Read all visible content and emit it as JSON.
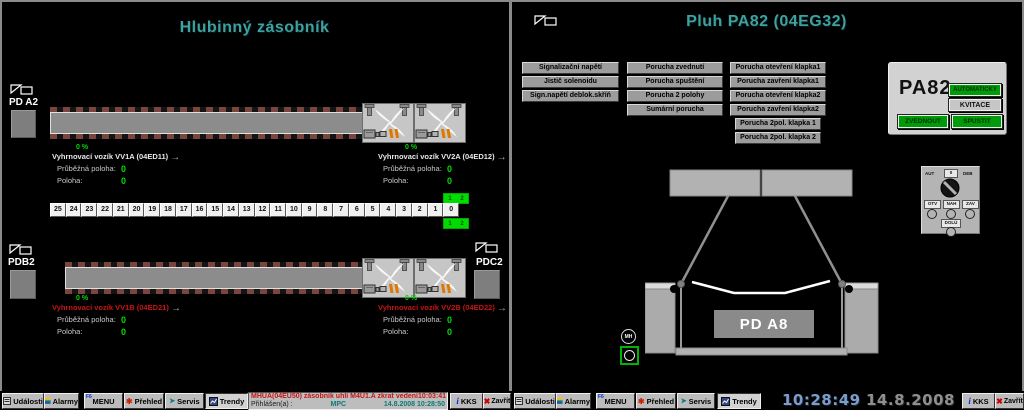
{
  "colors": {
    "teal": "#3FA0A0",
    "green": "#00DC00",
    "red": "#C81414",
    "btngreen": "#009A0A",
    "timeblue": "#7D9CC8",
    "dategray": "#8F8F8F",
    "statusgray": "#9C9C9C"
  },
  "left": {
    "title": "Hlubinný zásobník",
    "pd_a2": "PD A2",
    "pdb2": "PDB2",
    "pdc2": "PDC2",
    "pos_label": "Průběžná poloha:",
    "pos_label2": "Poloha:",
    "arrow": "→",
    "carts": {
      "vv1a": {
        "percent": "0 %",
        "label": "Vyhrnovací vozík VV1A (04ED11)",
        "style": "color:#e8e8e8",
        "v1": "0",
        "v2": "0"
      },
      "vv2a": {
        "percent": "0 %",
        "label": "Vyhrnovací vozík VV2A (04ED12)",
        "style": "color:#e8e8e8",
        "v1": "0",
        "v2": "0"
      },
      "vv1b": {
        "percent": "0 %",
        "label": "Vyhrnovací vozík VV1B (04ED21)",
        "style": "color:#C81414",
        "v1": "0",
        "v2": "0"
      },
      "vv2b": {
        "percent": "0 %",
        "label": "Vyhrnovací vozík VV2B (04ED22)",
        "style": "color:#C81414",
        "v1": "0",
        "v2": "0"
      }
    },
    "scale": {
      "cells": [
        "25",
        "24",
        "23",
        "22",
        "21",
        "20",
        "19",
        "18",
        "17",
        "16",
        "15",
        "14",
        "13",
        "12",
        "11",
        "10",
        "9",
        "8",
        "7",
        "6",
        "5",
        "4",
        "3",
        "2",
        "1",
        "0"
      ],
      "marker_a": "1",
      "marker_b": "2"
    }
  },
  "right": {
    "title": "Pluh PA82 (04EG32)",
    "status_col1": [
      "Signalizační napětí",
      "Jistič solenoidu",
      "Sign.napětí deblok.skříň"
    ],
    "status_col2": [
      "Porucha zvednutí",
      "Porucha spuštění",
      "Porucha 2 polohy",
      "Sumární porucha"
    ],
    "status_col3": [
      "Porucha otevření klapka1",
      "Porucha zavření klapka1",
      "Porucha otevření klapka2",
      "Porucha zavření klapka2",
      "Porucha 2pol. klapka 1",
      "Porucha 2pol. klapka 2"
    ],
    "control": {
      "name": "PA82",
      "auto": "AUTOMATICKY",
      "ack": "KVITACE",
      "raise": "ZVEDNOUT",
      "start": "SPUSTIT"
    },
    "pd_a8": "PD A8",
    "mh": "MH",
    "switch": {
      "left": "AUT",
      "mid": "0",
      "right": "DEB",
      "open": "OTV",
      "up": "NAH",
      "close": "ZAV",
      "down": "DOLŮ"
    }
  },
  "taskbar": {
    "buttons": [
      "Události",
      "Alarmy",
      "MENU",
      "Přehled",
      "Servis",
      "Trendy"
    ],
    "menu_key": "F6",
    "alarm_text": "MHUA(04EU50) zásobník uhlí M4U1.A zkrat vedení",
    "alarm_time": "10:03:41",
    "login_label": "Přihlášen(a) :",
    "login_user": "MPC",
    "login_datetime": "14.8.2008 10:28:50",
    "kks": "KKS",
    "close": "Zavřít",
    "clock_time": "10:28:49",
    "clock_date": "14.8.2008"
  }
}
